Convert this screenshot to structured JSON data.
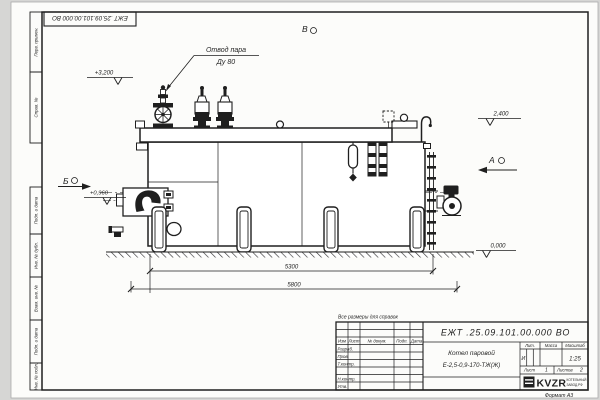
{
  "colors": {
    "ink": "#1f1f1f",
    "paper": "#fcfcfa"
  },
  "sheet": {
    "stamp_top": "ЕЖТ .25.09.101.00.000  ВО",
    "note": "Все размеры для справок",
    "format": "Формат  А3"
  },
  "margins": {
    "perv": "Перв. примен.",
    "sprav": "Справ. №",
    "podp1": "Подп. и дата",
    "inv_dubl": "Инв. № дубл.",
    "vzam": "Взам. инв. №",
    "podp2": "Подп. и дата",
    "inv_podl": "Инв. № подл."
  },
  "labels": {
    "steam1": "Отвод пара",
    "steam2": "Ду 80"
  },
  "views": {
    "a": "А",
    "b": "Б",
    "v": "В"
  },
  "elev": {
    "e3200": "+3,200",
    "e2400": "2,400",
    "e0960": "+0,960",
    "e0000": "0,000"
  },
  "dims": {
    "d5300": "5300",
    "d5800": "5800"
  },
  "tb": {
    "designation": "ЕЖТ .25.09.101.00.000  ВО",
    "name1": "Котел паровой",
    "name2": "Е-2,5-0,9-170-ТЖ(Ж)",
    "h_izm": "Изм",
    "h_list": "Лист",
    "h_dokum": "№ докум.",
    "h_podp": "Подп.",
    "h_data": "Дата",
    "r_razrab": "Разраб.",
    "r_prov": "Пров.",
    "r_tkontr": "Т.контр.",
    "r_nkontr": "Н.контр.",
    "r_utv": "Утв.",
    "h_lit": "Лит.",
    "h_massa": "Масса",
    "h_scale": "Масштаб",
    "litera": "И",
    "scale": "1:25",
    "sheet_label": "Лист",
    "sheet_num": "1",
    "sheets_label": "Листов",
    "sheets_num": "2",
    "logo": "KVZR",
    "logo_sub1": "КОТЕЛЬНЫЙ",
    "logo_sub2": "ЗАВОД.РФ"
  }
}
